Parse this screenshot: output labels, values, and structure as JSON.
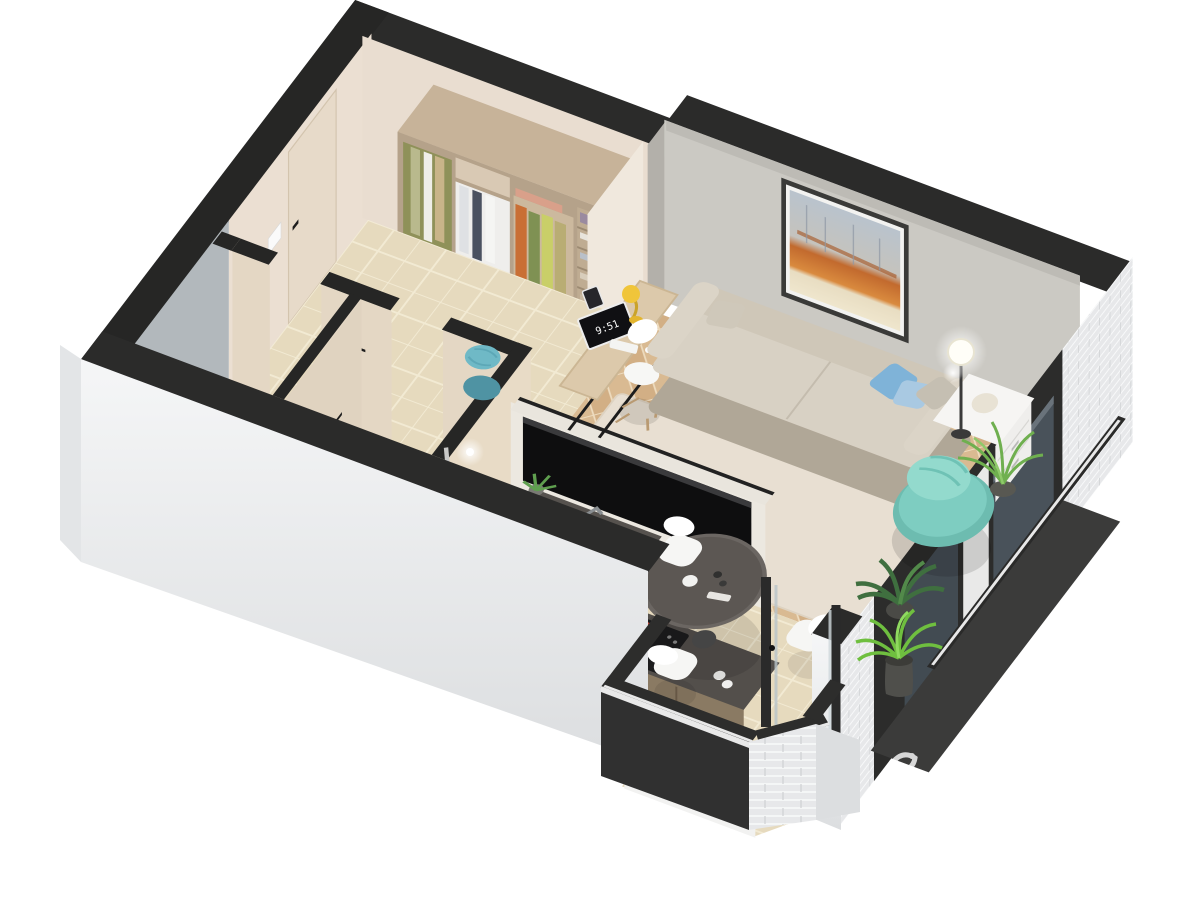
{
  "meta": {
    "kind": "3d-floor-plan-render",
    "view": "isometric cutaway, one-room apartment",
    "background": "#ffffff"
  },
  "watermark": {
    "logo": "cian-bird-logo",
    "text": "циан",
    "color": "#ffffff"
  },
  "desk": {
    "monitor_time": "9:51"
  },
  "rooms": [
    {
      "name": "entry-hall-wardrobe"
    },
    {
      "name": "living-room"
    },
    {
      "name": "kitchen-dining"
    },
    {
      "name": "bathroom"
    },
    {
      "name": "wc"
    },
    {
      "name": "loggia-bay"
    },
    {
      "name": "balcony"
    }
  ],
  "furniture": [
    "wardrobe-with-clothes",
    "entrance-door",
    "teal-pouf",
    "desk",
    "monitor",
    "desk-lamp",
    "desk-chair",
    "sofa",
    "pillows",
    "rug",
    "wall-art",
    "floor-lamp",
    "sideboard",
    "teal-armchair",
    "tv-panel",
    "kitchen-counter",
    "kitchen-sink",
    "cooktop",
    "fruit-bowl",
    "round-dining-table",
    "dining-chairs",
    "bathtub",
    "bathroom-sink",
    "toilet",
    "potted-plants",
    "loggia-plant"
  ],
  "palette": {
    "wall_cut": "#2b2b2a",
    "exterior_white": "#f2f3f4",
    "hall_wall": "#ebdfd2",
    "concrete_wall": "#cbc9c3",
    "tile_floor": "#e6dabe",
    "herringbone_floor": "#d9ba92",
    "rug": "#e8dfd2",
    "sofa": "#d8d1c4",
    "pillow_blue": "#7fb3d8",
    "armchair_teal": "#7ecdc1",
    "pouf_teal": "#6fb9c6",
    "counter_top": "#534f4b",
    "cabinet_wood": "#8a7a63",
    "painting_orange": "#c26a2e",
    "painting_sky": "#b9c3cd",
    "plant_green": "#6faf4f",
    "brick": "#e7e8ea",
    "burner_red": "#d94f3f"
  }
}
